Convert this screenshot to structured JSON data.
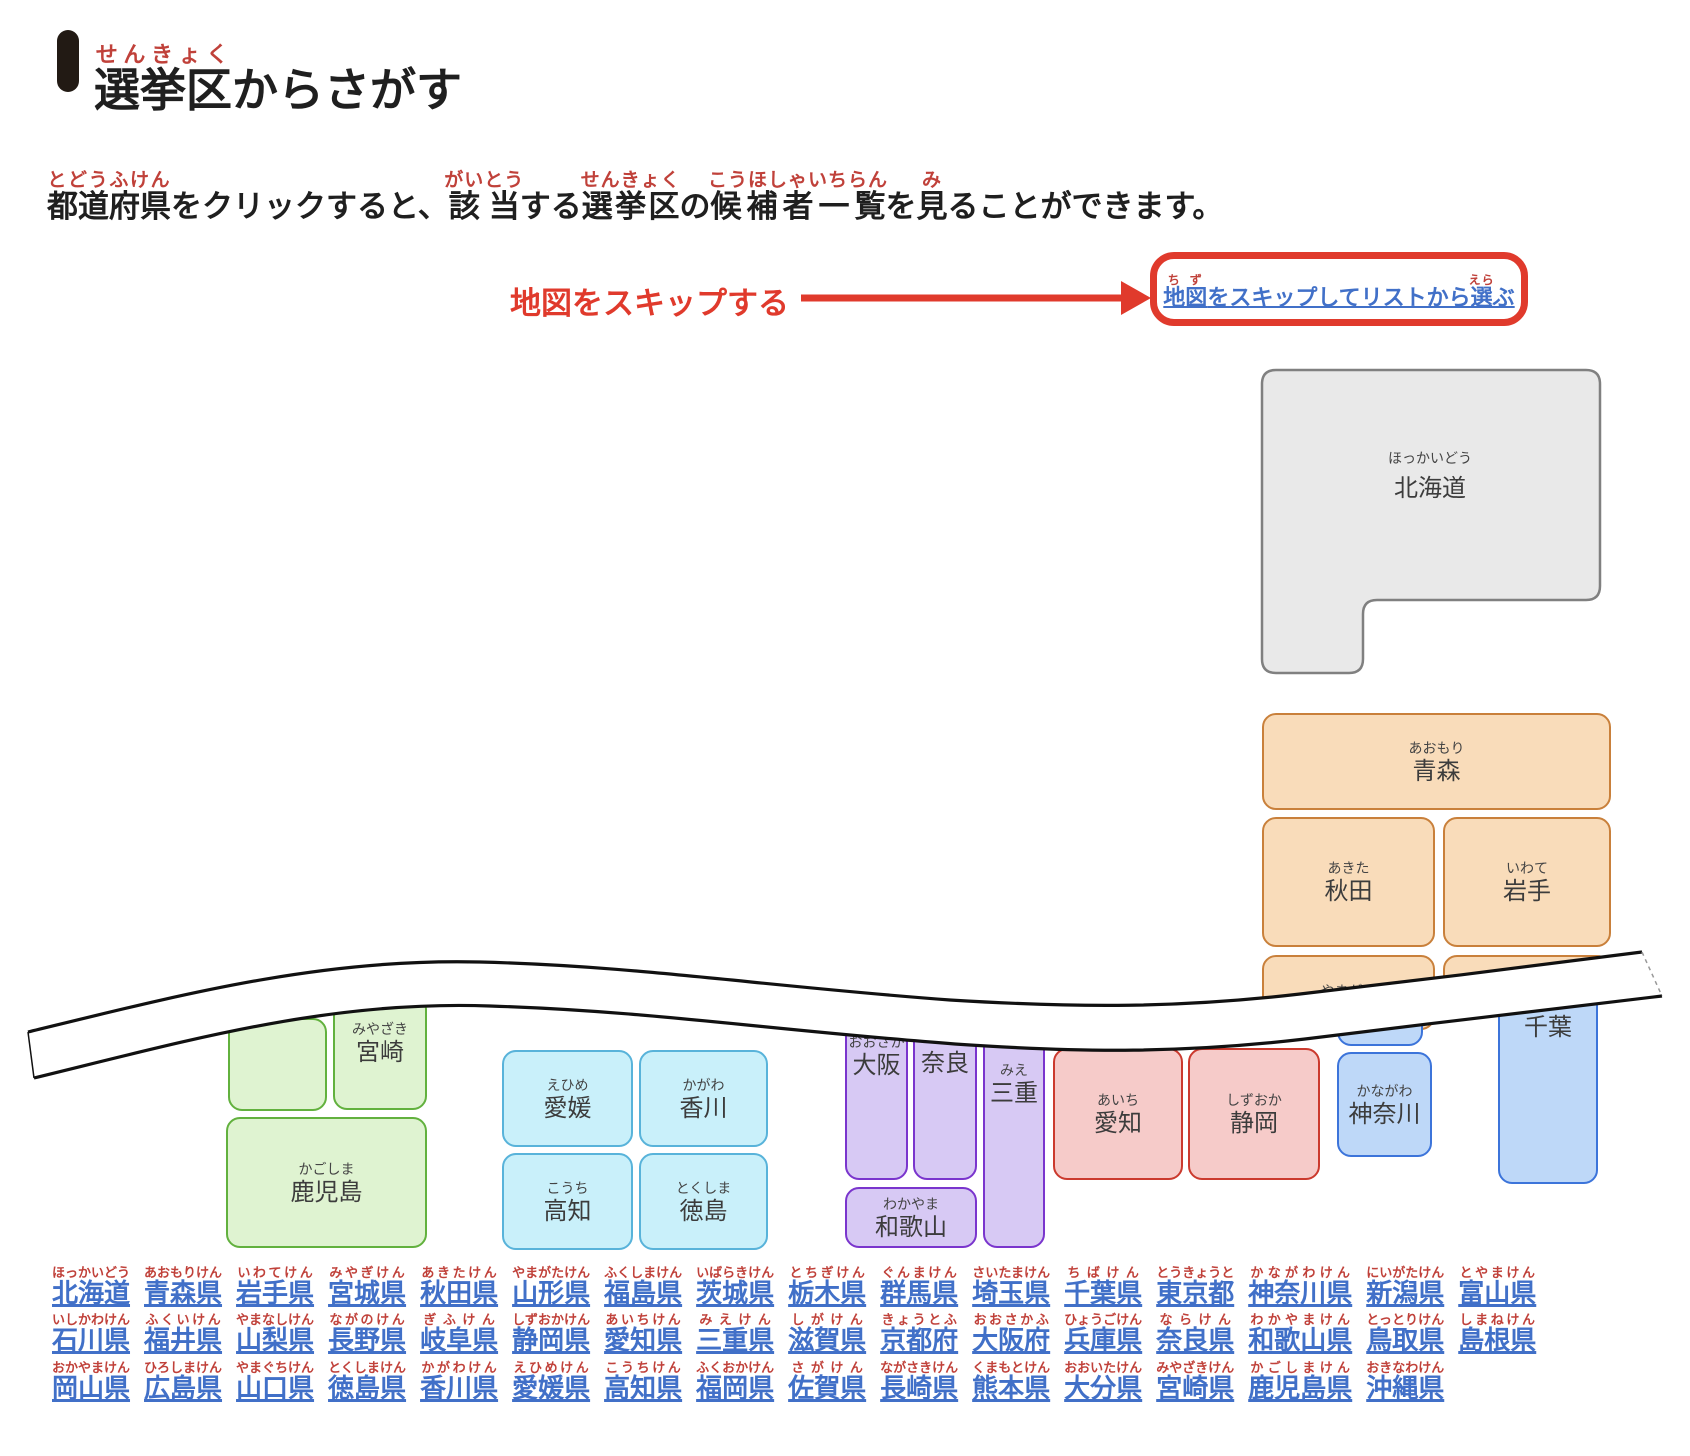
{
  "header": {
    "title_segments": [
      {
        "t": "選挙区",
        "r": "せんきょく"
      },
      {
        "t": "からさがす"
      }
    ]
  },
  "intro": {
    "segments": [
      {
        "t": "都道府県",
        "r": "とどうふけん"
      },
      {
        "t": "をクリックすると、"
      },
      {
        "t": "該当",
        "r": "がいとう"
      },
      {
        "t": "する"
      },
      {
        "t": "選挙区",
        "r": "せんきょく"
      },
      {
        "t": "の"
      },
      {
        "t": "候補者一覧",
        "r": "こうほしゃいちらん"
      },
      {
        "t": "を"
      },
      {
        "t": "見",
        "r": "み"
      },
      {
        "t": "ることができます。"
      }
    ]
  },
  "skip": {
    "annotation": "地図をスキップする",
    "link_segments": [
      {
        "t": "地図",
        "r": "ちず"
      },
      {
        "t": "をスキップしてリストから"
      },
      {
        "t": "選",
        "r": "えら"
      },
      {
        "t": "ぶ"
      }
    ]
  },
  "map": {
    "hokkaido": {
      "label": "北海道",
      "ruby": "ほっかいどう"
    },
    "blocks": [
      {
        "id": "aomori",
        "g": "orange",
        "x": 1262,
        "y": 713,
        "w": 349,
        "h": 97,
        "k": "青森",
        "r": "あおもり"
      },
      {
        "id": "akita",
        "g": "orange",
        "x": 1262,
        "y": 817,
        "w": 173,
        "h": 130,
        "k": "秋田",
        "r": "あきた"
      },
      {
        "id": "iwate",
        "g": "orange",
        "x": 1443,
        "y": 817,
        "w": 168,
        "h": 130,
        "k": "岩手",
        "r": "いわて"
      },
      {
        "id": "yamagata",
        "g": "orange",
        "x": 1262,
        "y": 955,
        "w": 173,
        "h": 75,
        "k": "",
        "r": "やまがた",
        "ly": 24
      },
      {
        "id": "miyagi",
        "g": "orange",
        "x": 1443,
        "y": 955,
        "w": 168,
        "h": 48,
        "k": "",
        "r": ""
      },
      {
        "id": "kyushu-cut",
        "g": "green",
        "x": 228,
        "y": 1018,
        "w": 99,
        "h": 93,
        "k": "",
        "r": ""
      },
      {
        "id": "miyazaki",
        "g": "green",
        "x": 333,
        "y": 995,
        "w": 94,
        "h": 115,
        "k": "宮崎",
        "r": "みやざき",
        "ly": 22
      },
      {
        "id": "kagoshima",
        "g": "green",
        "x": 226,
        "y": 1117,
        "w": 201,
        "h": 131,
        "k": "鹿児島",
        "r": "かごしま"
      },
      {
        "id": "ehime",
        "g": "cyan",
        "x": 502,
        "y": 1050,
        "w": 131,
        "h": 97,
        "k": "愛媛",
        "r": "えひめ"
      },
      {
        "id": "kagawa",
        "g": "cyan",
        "x": 639,
        "y": 1050,
        "w": 129,
        "h": 97,
        "k": "香川",
        "r": "かがわ"
      },
      {
        "id": "kochi",
        "g": "cyan",
        "x": 502,
        "y": 1153,
        "w": 131,
        "h": 97,
        "k": "高知",
        "r": "こうち"
      },
      {
        "id": "tokushima",
        "g": "cyan",
        "x": 639,
        "y": 1153,
        "w": 129,
        "h": 97,
        "k": "徳島",
        "r": "とくしま"
      },
      {
        "id": "osaka",
        "g": "purple",
        "x": 845,
        "y": 1022,
        "w": 63,
        "h": 158,
        "k": "大阪",
        "r": "おおさか",
        "ly": 8
      },
      {
        "id": "nara",
        "g": "purple",
        "x": 913,
        "y": 1022,
        "w": 64,
        "h": 158,
        "k": "奈良",
        "r": "",
        "ly": 26
      },
      {
        "id": "mie",
        "g": "purple",
        "x": 983,
        "y": 1030,
        "w": 62,
        "h": 218,
        "k": "三重",
        "r": "みえ",
        "ly": 28
      },
      {
        "id": "wakayama",
        "g": "purple",
        "x": 845,
        "y": 1187,
        "w": 132,
        "h": 61,
        "k": "和歌山",
        "r": "わかやま"
      },
      {
        "id": "aichi",
        "g": "red",
        "x": 1053,
        "y": 1048,
        "w": 130,
        "h": 132,
        "k": "愛知",
        "r": "あいち"
      },
      {
        "id": "shizuoka",
        "g": "red",
        "x": 1188,
        "y": 1048,
        "w": 132,
        "h": 132,
        "k": "静岡",
        "r": "しずおか"
      },
      {
        "id": "tokyo-cut",
        "g": "blue",
        "x": 1337,
        "y": 998,
        "w": 86,
        "h": 48,
        "k": "",
        "r": ""
      },
      {
        "id": "kanagawa",
        "g": "blue",
        "x": 1337,
        "y": 1052,
        "w": 95,
        "h": 105,
        "k": "神奈川",
        "r": "かながわ"
      },
      {
        "id": "chiba",
        "g": "blue",
        "x": 1498,
        "y": 988,
        "w": 100,
        "h": 196,
        "k": "千葉",
        "r": "",
        "ly": 24
      }
    ]
  },
  "prefecture_links": {
    "rows": [
      [
        {
          "k": "北海道",
          "r": "ほっかいどう"
        },
        {
          "k": "青森県",
          "r": "あおもりけん"
        },
        {
          "k": "岩手県",
          "r": "いわてけん"
        },
        {
          "k": "宮城県",
          "r": "みやぎけん"
        },
        {
          "k": "秋田県",
          "r": "あきたけん"
        },
        {
          "k": "山形県",
          "r": "やまがたけん"
        },
        {
          "k": "福島県",
          "r": "ふくしまけん"
        },
        {
          "k": "茨城県",
          "r": "いばらきけん"
        },
        {
          "k": "栃木県",
          "r": "とちぎけん"
        },
        {
          "k": "群馬県",
          "r": "ぐんまけん"
        },
        {
          "k": "埼玉県",
          "r": "さいたまけん"
        },
        {
          "k": "千葉県",
          "r": "ちばけん"
        },
        {
          "k": "東京都",
          "r": "とうきょうと"
        },
        {
          "k": "神奈川県",
          "r": "かながわけん"
        },
        {
          "k": "新潟県",
          "r": "にいがたけん"
        },
        {
          "k": "富山県",
          "r": "とやまけん"
        }
      ],
      [
        {
          "k": "石川県",
          "r": "いしかわけん"
        },
        {
          "k": "福井県",
          "r": "ふくいけん"
        },
        {
          "k": "山梨県",
          "r": "やまなしけん"
        },
        {
          "k": "長野県",
          "r": "ながのけん"
        },
        {
          "k": "岐阜県",
          "r": "ぎふけん"
        },
        {
          "k": "静岡県",
          "r": "しずおかけん"
        },
        {
          "k": "愛知県",
          "r": "あいちけん"
        },
        {
          "k": "三重県",
          "r": "みえけん"
        },
        {
          "k": "滋賀県",
          "r": "しがけん"
        },
        {
          "k": "京都府",
          "r": "きょうとふ"
        },
        {
          "k": "大阪府",
          "r": "おおさかふ"
        },
        {
          "k": "兵庫県",
          "r": "ひょうごけん"
        },
        {
          "k": "奈良県",
          "r": "ならけん"
        },
        {
          "k": "和歌山県",
          "r": "わかやまけん"
        },
        {
          "k": "鳥取県",
          "r": "とっとりけん"
        },
        {
          "k": "島根県",
          "r": "しまねけん"
        }
      ],
      [
        {
          "k": "岡山県",
          "r": "おかやまけん"
        },
        {
          "k": "広島県",
          "r": "ひろしまけん"
        },
        {
          "k": "山口県",
          "r": "やまぐちけん"
        },
        {
          "k": "徳島県",
          "r": "とくしまけん"
        },
        {
          "k": "香川県",
          "r": "かがわけん"
        },
        {
          "k": "愛媛県",
          "r": "えひめけん"
        },
        {
          "k": "高知県",
          "r": "こうちけん"
        },
        {
          "k": "福岡県",
          "r": "ふくおかけん"
        },
        {
          "k": "佐賀県",
          "r": "さがけん"
        },
        {
          "k": "長崎県",
          "r": "ながさきけん"
        },
        {
          "k": "熊本県",
          "r": "くまもとけん"
        },
        {
          "k": "大分県",
          "r": "おおいたけん"
        },
        {
          "k": "宮崎県",
          "r": "みやざきけん"
        },
        {
          "k": "鹿児島県",
          "r": "かごしまけん"
        },
        {
          "k": "沖縄県",
          "r": "おきなわけん"
        }
      ]
    ]
  },
  "palette": {
    "furigana_red": "#c0413a",
    "annotation_red": "#e03a2c",
    "link_blue": "#4170c8",
    "text_dark": "#1f1f1f",
    "block_label": "#3c3c3c",
    "groups": {
      "gray": {
        "fill": "#e9e9e9",
        "border": "#808080"
      },
      "orange": {
        "fill": "#f9dcba",
        "border": "#c9803b"
      },
      "green": {
        "fill": "#dff3d1",
        "border": "#62b13e"
      },
      "cyan": {
        "fill": "#c9f0fa",
        "border": "#58b3da"
      },
      "purple": {
        "fill": "#d7c9f4",
        "border": "#7a35cd"
      },
      "red": {
        "fill": "#f6cbc9",
        "border": "#cb3a2e"
      },
      "blue": {
        "fill": "#bed8f8",
        "border": "#3c74da"
      }
    }
  }
}
